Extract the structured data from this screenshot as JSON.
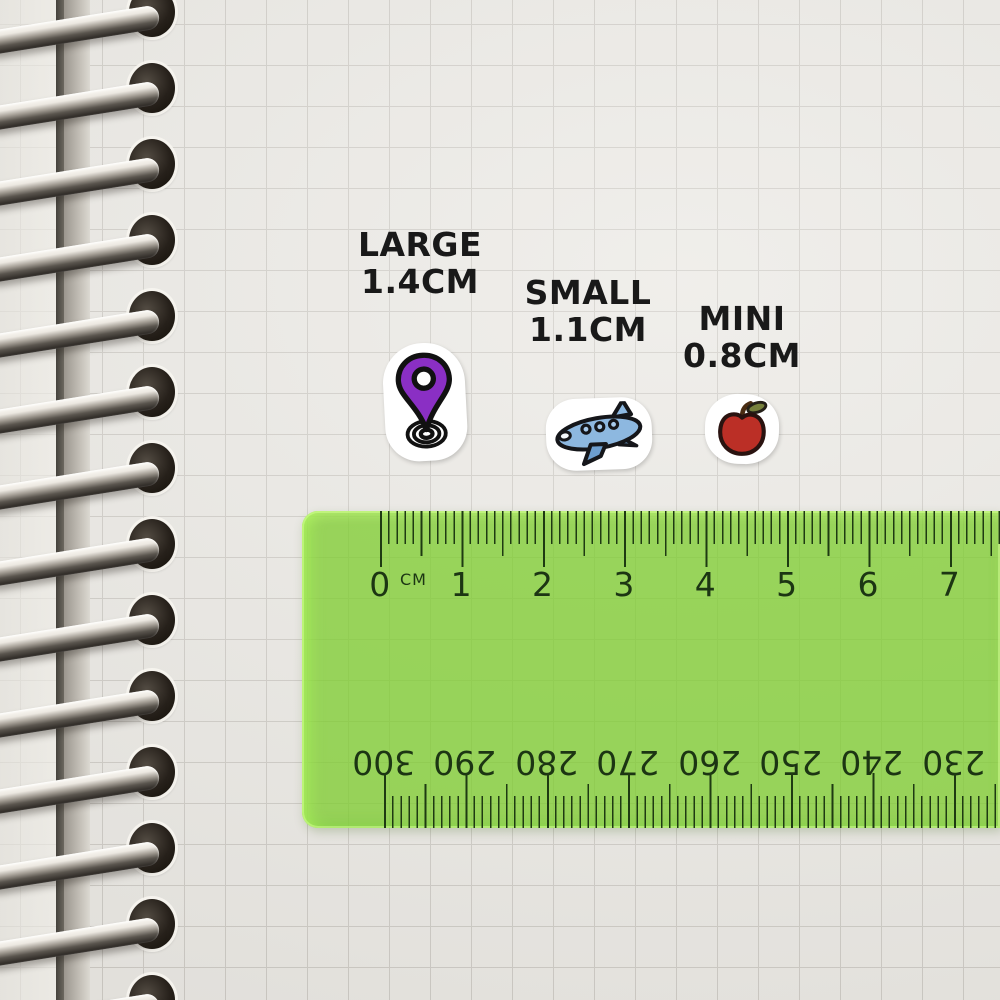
{
  "stickers": [
    {
      "icon": "location-pin-icon",
      "label": "LARGE",
      "size": "1.4CM",
      "color": "#8a2fc4"
    },
    {
      "icon": "airplane-icon",
      "label": "SMALL",
      "size": "1.1CM",
      "color": "#8db8e0"
    },
    {
      "icon": "apple-icon",
      "label": "MINI",
      "size": "0.8CM",
      "color": "#bb2f26"
    }
  ],
  "ruler": {
    "unit_label": "CM",
    "cm_labels": [
      "0",
      "1",
      "2",
      "3",
      "4",
      "5",
      "6",
      "7"
    ],
    "mm_labels": [
      "300",
      "290",
      "280",
      "270",
      "260",
      "250",
      "240",
      "230"
    ],
    "body_color": "#8ccf4e",
    "marking_color": "#1e3a12"
  },
  "colors": {
    "paper": "#eae8e3",
    "grid_line": "#cecbc5",
    "label_text": "#191919"
  }
}
